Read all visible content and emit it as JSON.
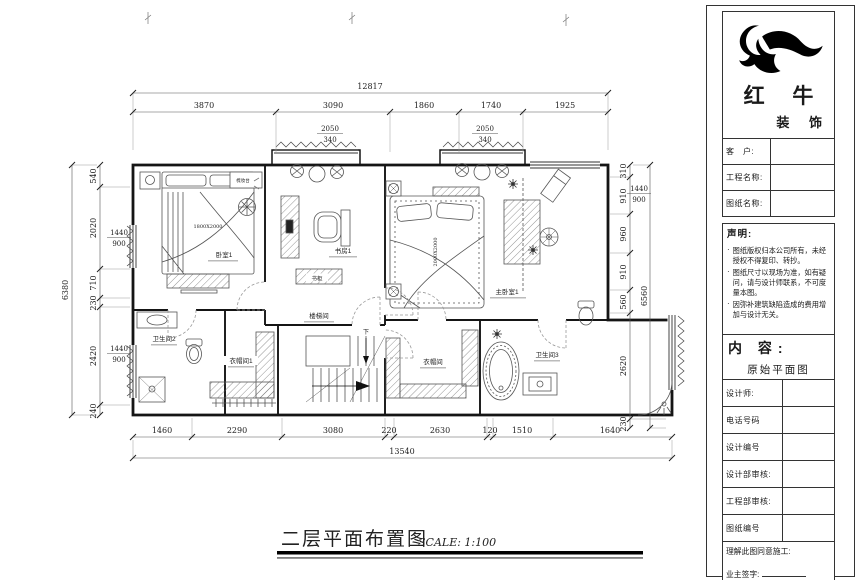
{
  "colors": {
    "line": "#1a1a1a",
    "paper": "#ffffff"
  },
  "drawing": {
    "title": "二层平面布置图",
    "scale_label": "SCALE: 1:100",
    "dims": {
      "top_overall": "12817",
      "top": [
        "3870",
        "3090",
        "1860",
        "1740",
        "1925"
      ],
      "bottom": [
        "1460",
        "2290",
        "3080",
        "220",
        "2630",
        "120",
        "1510",
        "1640"
      ],
      "bottom_overall": "13540",
      "left_overall": "6380",
      "left": [
        "540",
        "2020",
        "710",
        "230",
        "2420",
        "240"
      ],
      "right": [
        "310",
        "910",
        "960",
        "910",
        "560",
        "2620",
        "230"
      ],
      "right_overall": "6560"
    },
    "windows": [
      {
        "w": "2050",
        "h": "340"
      },
      {
        "w": "2050",
        "h": "340"
      },
      {
        "w": "1440",
        "h": "900"
      },
      {
        "w": "1440",
        "h": "900"
      },
      {
        "w": "1440",
        "h": "900"
      }
    ],
    "rooms": {
      "bedroom1": "卧室1",
      "study": "书房1",
      "master_bedroom": "主卧室1",
      "stairwell": "楼梯间",
      "bathroom2": "卫生间2",
      "cloakroom1": "衣帽间1",
      "cloakroom2": "衣帽间",
      "bathroom3": "卫生间3",
      "bookcase": "书柜",
      "dressing_table": "梳妆台",
      "stairs_down": "下"
    },
    "furniture": {
      "bed1_size": "1800X2000",
      "bed2_size": "2000X2000"
    }
  },
  "title_block": {
    "brand_name": "红 牛",
    "brand_sub": "装 饰",
    "client_label": "客　户:",
    "project_label": "工程名称:",
    "drawing_name_label": "图纸名称:",
    "statement_heading": "声明:",
    "statement_items": [
      "图纸版权归本公司所有，未经授权不得复印、转抄。",
      "图纸尺寸以现场为准，如有疑问，请与设计师联系，不可度量本图。",
      "因弥补建筑缺陷造成的费用增加与设计无关。"
    ],
    "content_heading": "内 容:",
    "content_value": "原始平面图",
    "designer_label": "设计师:",
    "phone_label": "电话号码",
    "design_no_label": "设计编号",
    "design_review_label": "设计部审核:",
    "engineering_review_label": "工程部审核:",
    "drawing_no_label": "图纸编号",
    "agree_label": "理解此图同意施工:",
    "owner_sign_label": "业主签字:"
  }
}
